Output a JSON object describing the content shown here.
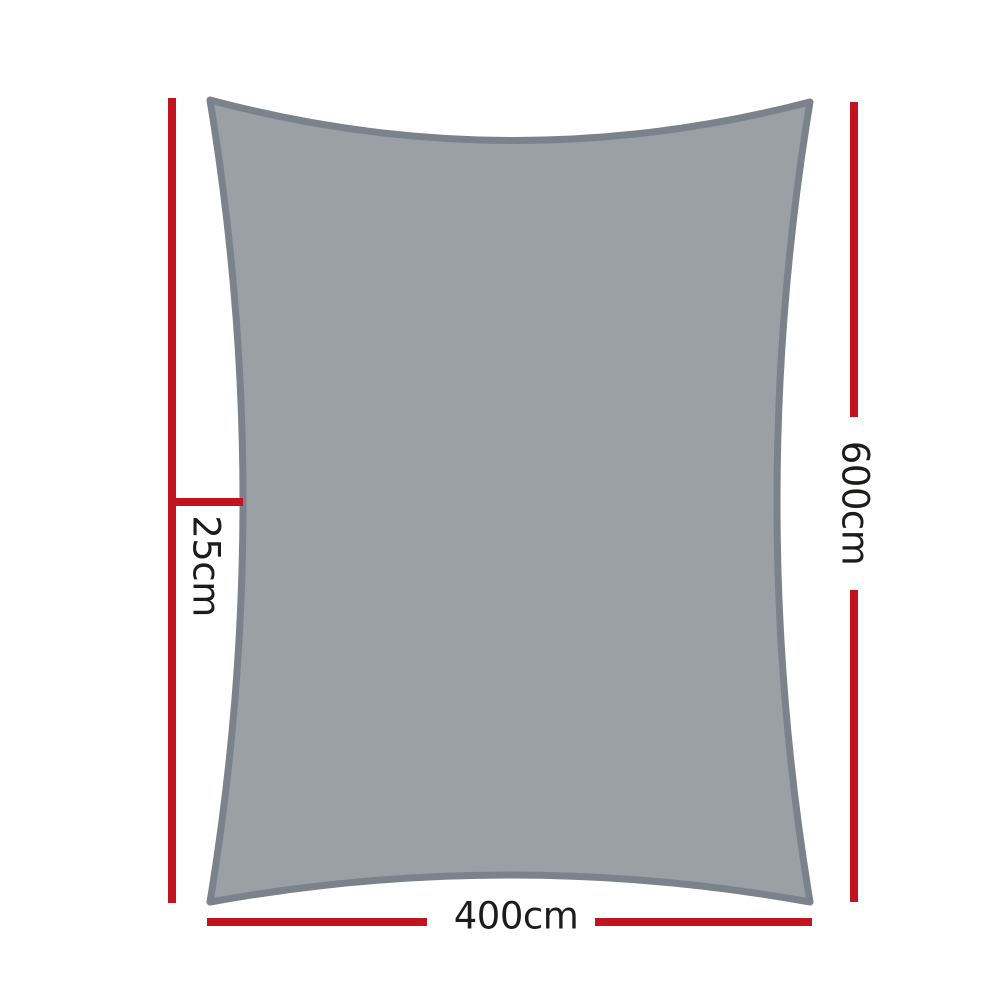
{
  "diagram": {
    "type": "product-dimension-diagram",
    "subject": "rectangle shade sail",
    "labels": {
      "left_offset": "25cm",
      "right_height": "600cm",
      "bottom_width": "400cm"
    }
  },
  "colors": {
    "dimension_line_red": "#c1141f",
    "sail_fill_gray": "#9ba0a7",
    "sail_stroke_gray": "#7c828c",
    "label_text": "#1c1c1a",
    "background": "#ffffff"
  }
}
